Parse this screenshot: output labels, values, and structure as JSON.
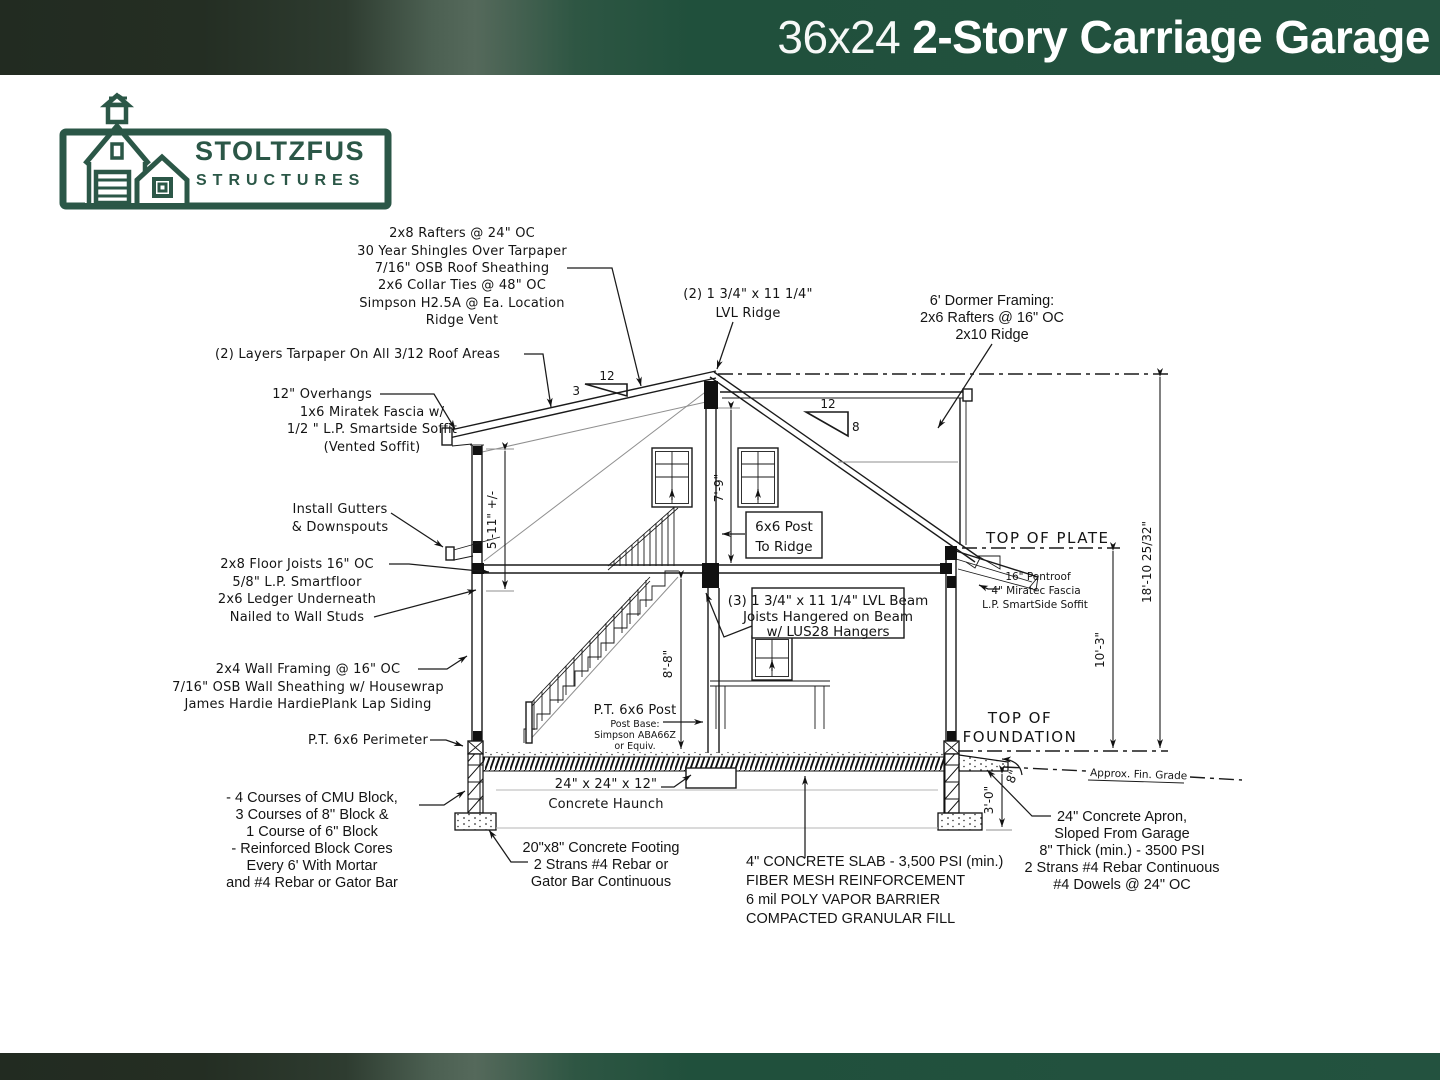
{
  "header": {
    "title_light": "36x24",
    "title_bold": "2-Story Carriage Garage"
  },
  "logo": {
    "name_line1": "STOLTZFUS",
    "name_line2": "STRUCTURES"
  },
  "colors": {
    "brand_green": "#2b5747",
    "header_green": "#23523f",
    "line": "#1a1a1a"
  },
  "ann": {
    "roof_notes": [
      "2x8 Rafters @ 24\" OC",
      "30 Year Shingles Over Tarpaper",
      "7/16\" OSB Roof Sheathing",
      "2x6 Collar Ties @ 48\" OC",
      "Simpson H2.5A @ Ea. Location",
      "Ridge Vent"
    ],
    "tarpaper": "(2) Layers Tarpaper On All 3/12 Roof Areas",
    "overhangs": [
      "12\" Overhangs",
      "1x6 Miratek Fascia w/",
      "1/2 \" L.P. Smartside Soffit",
      "(Vented Soffit)"
    ],
    "gutters": [
      "Install Gutters",
      "& Downspouts"
    ],
    "floor_joists": [
      "2x8 Floor Joists 16\" OC",
      "5/8\" L.P. Smartfloor",
      "2x6 Ledger Underneath",
      "Nailed to Wall Studs"
    ],
    "wall_framing": [
      "2x4 Wall Framing @ 16\" OC",
      "7/16\" OSB Wall Sheathing w/ Housewrap",
      "James Hardie HardiePlank Lap Siding"
    ],
    "perimeter": "P.T. 6x6 Perimeter",
    "cmu": [
      "- 4 Courses of CMU Block,",
      "3 Courses of 8'' Block &",
      "1 Course of 6\" Block",
      "- Reinforced Block Cores",
      "Every 6' With Mortar",
      "and #4 Rebar or Gator Bar"
    ],
    "footing": [
      "20\"x8\" Concrete Footing",
      "2 Strans #4 Rebar or",
      "Gator Bar Continuous"
    ],
    "haunch": [
      "24\" x 24\" x 12\"",
      "Concrete Haunch"
    ],
    "slab": [
      "4\" CONCRETE SLAB - 3,500 PSI (min.)",
      "FIBER MESH REINFORCEMENT",
      "6 mil POLY VAPOR BARRIER",
      "COMPACTED GRANULAR FILL"
    ],
    "apron": [
      "24\" Concrete Apron,",
      "Sloped From Garage",
      "8\" Thick (min.) - 3500 PSI",
      "2 Strans #4 Rebar Continuous",
      "#4 Dowels @ 24\" OC"
    ],
    "lvl_ridge": [
      "(2) 1 3/4\" x 11 1/4\"",
      "LVL Ridge"
    ],
    "dormer": [
      "6' Dormer Framing:",
      "2x6 Rafters @ 16\" OC",
      "2x10 Ridge"
    ],
    "post_box": [
      "6x6 Post",
      "To Ridge"
    ],
    "beam_box": [
      "(3) 1 3/4\" x 11 1/4\" LVL Beam",
      "Joists Hangered on Beam",
      "w/ LUS28 Hangers"
    ],
    "pt_post": [
      "P.T. 6x6 Post",
      "Post Base:",
      "Simpson ABA66Z",
      "or Equiv."
    ],
    "pentroof": [
      "16\" Pentroof",
      "4\" Miratec Fascia",
      "L.P. SmartSide Soffit"
    ],
    "levels": {
      "top_of_plate": "TOP OF PLATE",
      "top_of_foundation_1": "TOP OF",
      "top_of_foundation_2": "FOUNDATION",
      "grade": "Approx. Fin. Grade"
    },
    "dims": {
      "wall_height": "5'-11\" +/-",
      "attic_height": "7'-9\"",
      "first_floor_height": "8'-8\"",
      "plate_height": "10'-3\"",
      "ridge_height": "18'-10 25/32\"",
      "frost_depth": "3'-0\"",
      "apron_thickness": "8\"",
      "slope_left_run": "12",
      "slope_left_rise": "3",
      "slope_right_run": "12",
      "slope_right_rise": "8"
    }
  }
}
